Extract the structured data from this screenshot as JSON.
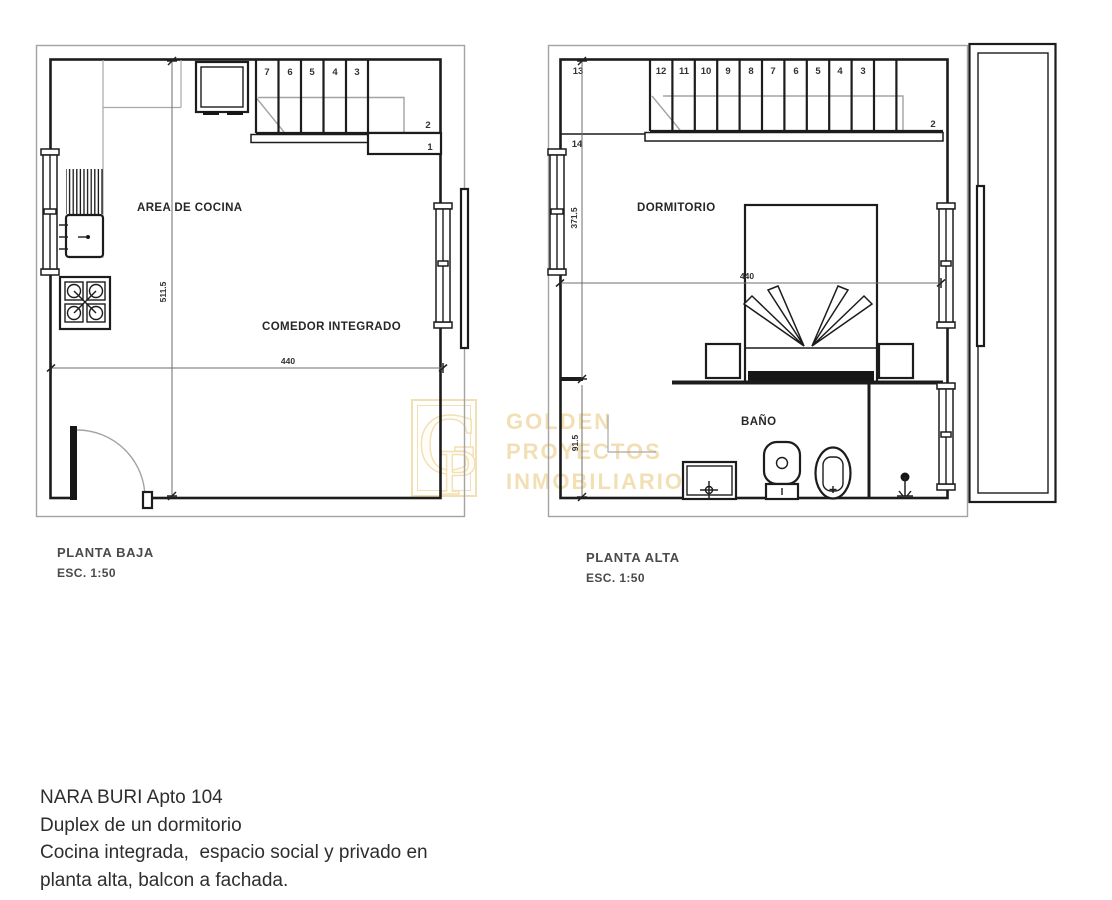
{
  "watermark": {
    "logo": {
      "letter_g": "G",
      "letter_p": "P"
    },
    "lines": [
      "GOLDEN",
      "PROYECTOS",
      "INMOBILIARIOS"
    ],
    "color": "#f2dfb4"
  },
  "plans": {
    "planta_baja": {
      "title": "PLANTA BAJA",
      "scale": "ESC. 1:50",
      "labels": {
        "kitchen": "AREA DE COCINA",
        "dining": "COMEDOR INTEGRADO"
      },
      "dimensions": {
        "width": "440",
        "height": "511.5"
      },
      "stair_numbers": {
        "treads": [
          "7",
          "6",
          "5",
          "4",
          "3"
        ],
        "landing": "2",
        "first_step": "1"
      }
    },
    "planta_alta": {
      "title": "PLANTA ALTA",
      "scale": "ESC. 1:50",
      "labels": {
        "bedroom": "DORMITORIO",
        "bathroom": "BAÑO"
      },
      "dimensions": {
        "width": "440",
        "bedroom_height": "371.5",
        "bathroom_height": "91.5"
      },
      "stair_numbers": {
        "treads": [
          "12",
          "11",
          "10",
          "9",
          "8",
          "7",
          "6",
          "5",
          "4",
          "3"
        ],
        "landing_top": "13",
        "last_step": "14",
        "landing_bottom": "2"
      }
    }
  },
  "description": {
    "lines": [
      "NARA BURI Apto 104",
      "Duplex de un dormitorio",
      "Cocina integrada,  espacio social y privado en",
      "planta alta, balcon a fachada."
    ]
  }
}
